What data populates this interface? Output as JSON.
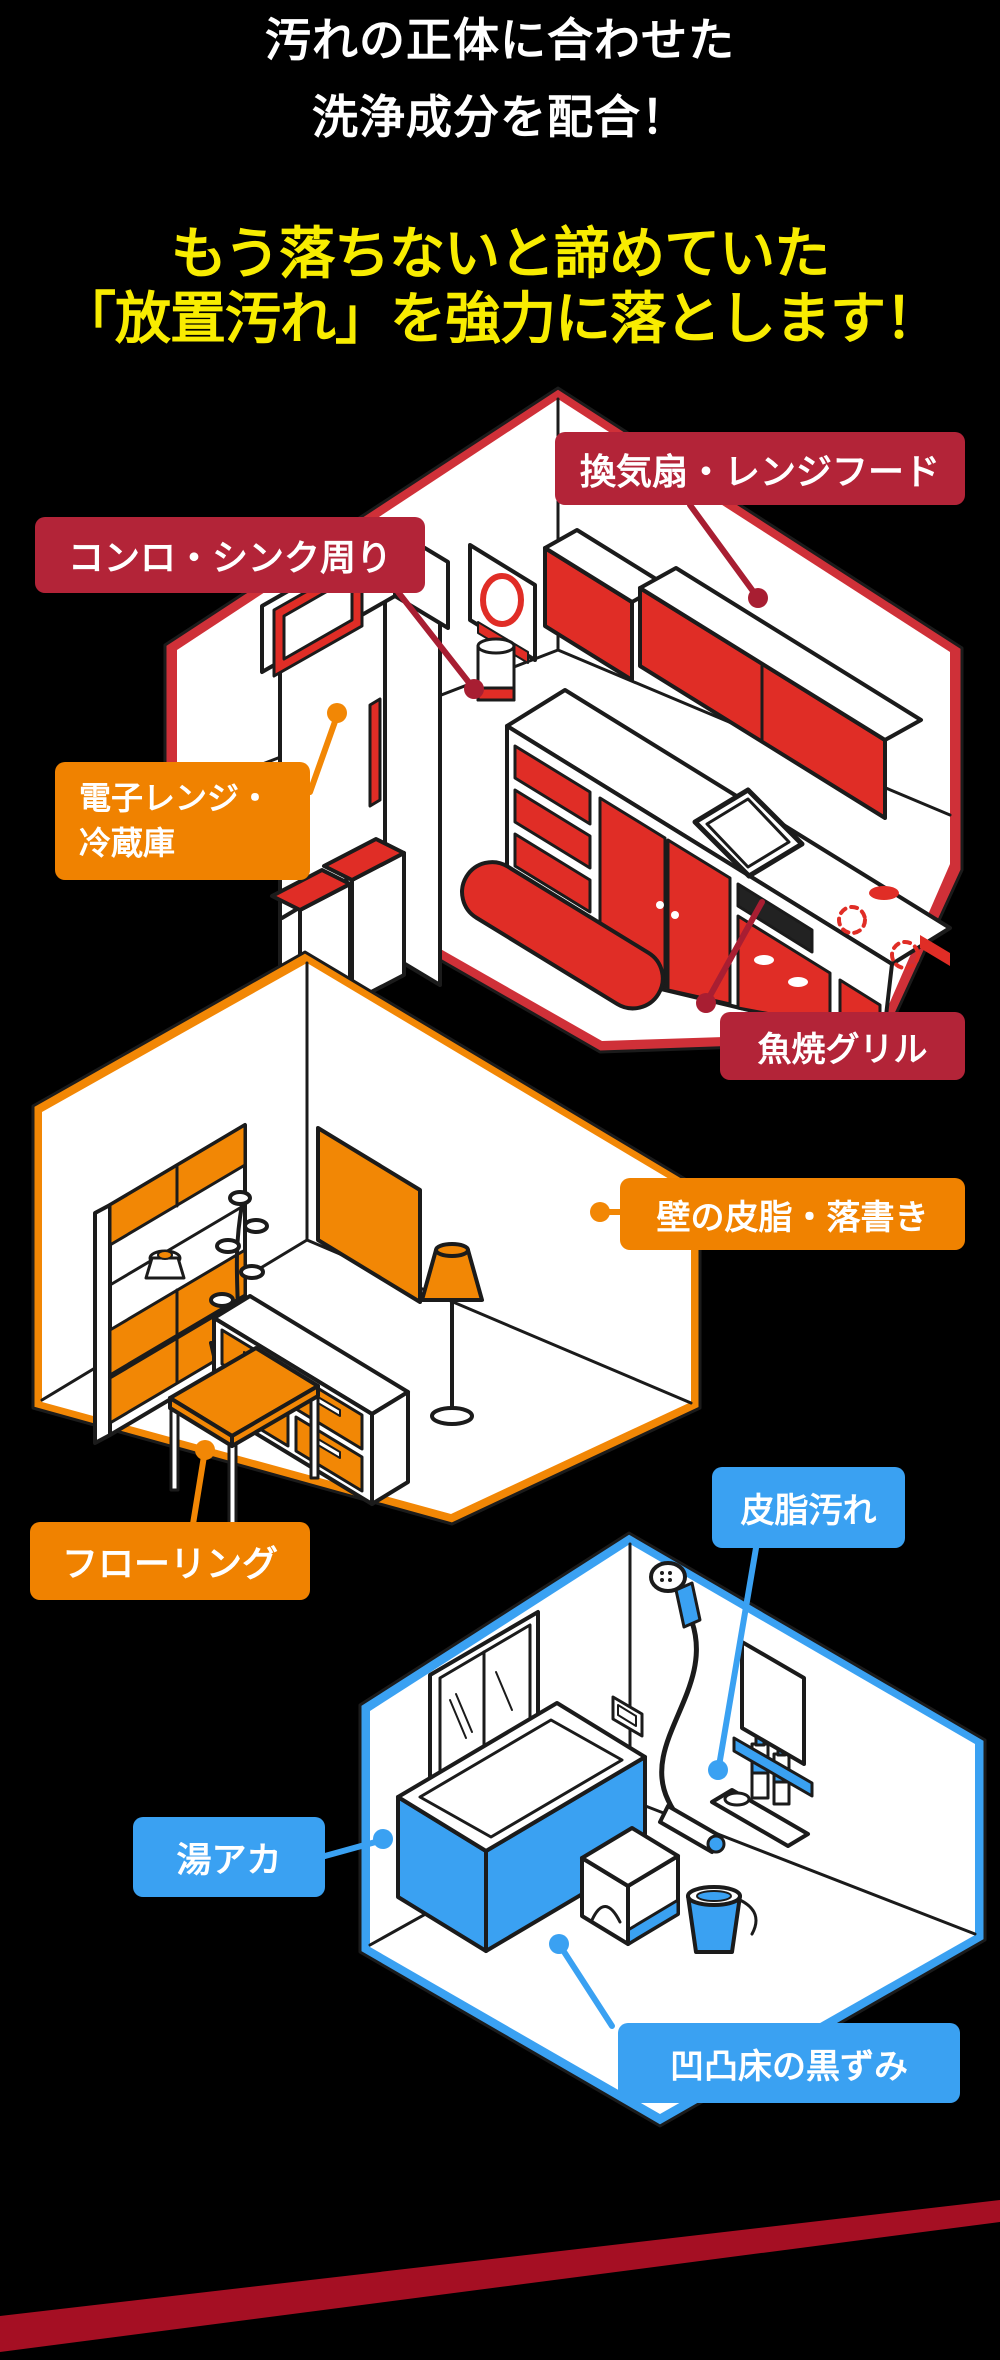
{
  "page": {
    "background": "#000000"
  },
  "header": {
    "subtitle": {
      "line1": "汚れの正体に合わせた",
      "line2": "洗浄成分を配合！",
      "color": "#ffffff"
    },
    "title": {
      "line1": "もう落ちないと諦めていた",
      "line2": "「放置汚れ」を強力に落とします！",
      "color": "#f8ec00"
    }
  },
  "rooms": [
    {
      "id": "kitchen",
      "accent": "#e02d26",
      "trim": "#cf3038",
      "items": [
        "microwave-icon",
        "refrigerator-icon",
        "trash-bins-icon",
        "ventilation-fan-icon",
        "range-hood-cabinet-icon",
        "kitchen-counter-icon",
        "sink-icon",
        "stove-burners-icon",
        "fish-grill-icon",
        "blender-icon",
        "floor-mat-icon"
      ]
    },
    {
      "id": "living-room",
      "accent": "#f28705",
      "trim": "#f28705",
      "items": [
        "bookshelf-icon",
        "potted-plant-icon",
        "tv-icon",
        "tv-stand-icon",
        "floor-lamp-icon",
        "low-table-icon"
      ]
    },
    {
      "id": "bathroom",
      "accent": "#3aa1f2",
      "trim": "#3aa1f2",
      "items": [
        "window-icon",
        "bathtub-icon",
        "shower-head-icon",
        "bath-stool-icon",
        "wash-bucket-icon",
        "shampoo-shelf-icon",
        "mirror-icon"
      ]
    }
  ],
  "labels": [
    {
      "id": "vent",
      "text": "換気扇・レンジフード",
      "color": "#b32438"
    },
    {
      "id": "stove",
      "text": "コンロ・シンク周り",
      "color": "#b32438"
    },
    {
      "id": "fridge",
      "text": "電子レンジ・\n冷蔵庫",
      "color": "#f08200"
    },
    {
      "id": "grill",
      "text": "魚焼グリル",
      "color": "#b32438"
    },
    {
      "id": "wall",
      "text": "壁の皮脂・落書き",
      "color": "#f08200"
    },
    {
      "id": "floor",
      "text": "フローリング",
      "color": "#f08200"
    },
    {
      "id": "sebum",
      "text": "皮脂汚れ",
      "color": "#3aa1f2"
    },
    {
      "id": "yuaka",
      "text": "湯アカ",
      "color": "#3aa1f2"
    },
    {
      "id": "uneven",
      "text": "凹凸床の黒ずみ",
      "color": "#3aa1f2"
    }
  ],
  "footer": {
    "ribbon_color": "#a50f23"
  }
}
